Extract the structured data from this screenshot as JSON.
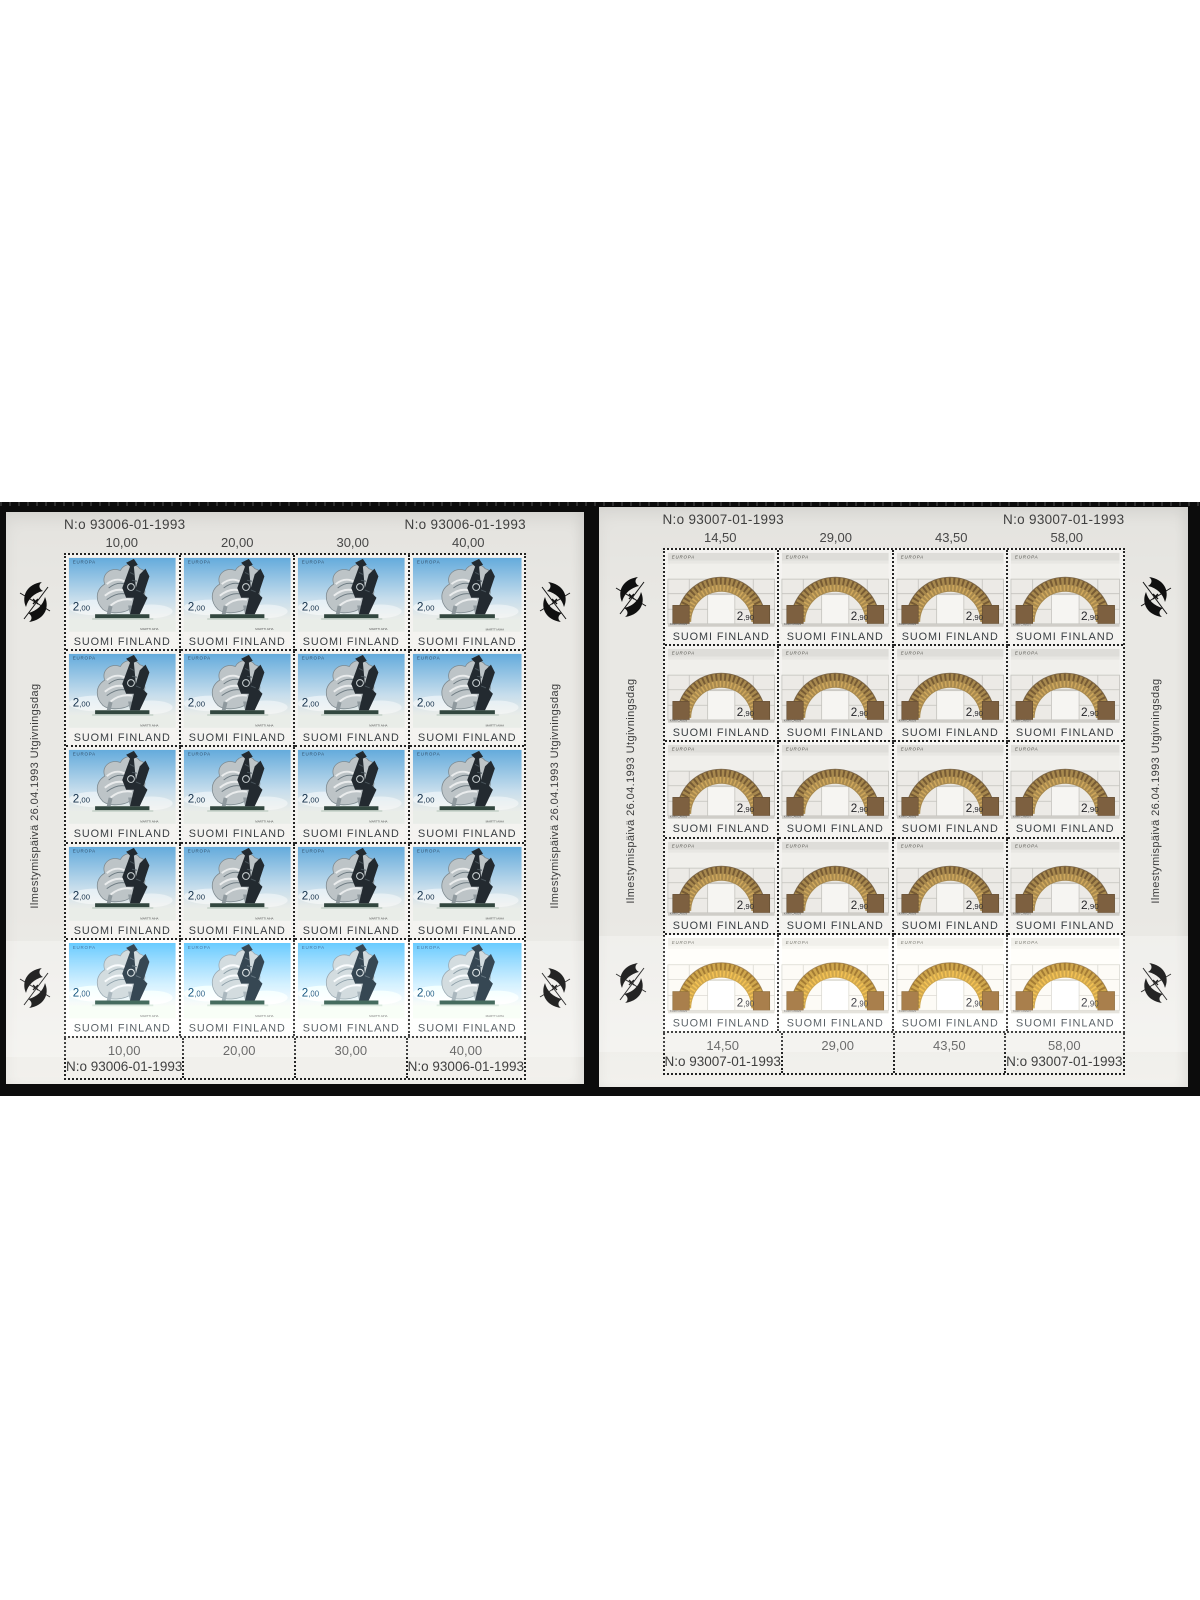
{
  "page": {
    "background": "#ffffff",
    "backdrop_color": "#0c0c0c"
  },
  "palette": {
    "paper": "#e9e8e4",
    "paper2": "#f2f1ed",
    "band": "#0c0c0c",
    "perf": "#232323",
    "ink": "#3e3e3e",
    "sky_top": "#64abdc",
    "sky_mid": "#c6ddec",
    "gray": "#bdc4c7",
    "dark": "#232a30",
    "plinth": "#32473f",
    "rbg": "#f0efeb",
    "arch": "#a8894e",
    "arch_dark": "#6e5430",
    "arch_light": "#d2ab5e",
    "pillar": "#7d6040",
    "panel_line": "#c3c2bd"
  },
  "sheets": [
    {
      "title": "Finland Europa 1993 sheet, 2,00 mk",
      "stamp_template": "stamp-left",
      "rows": 5,
      "cols": 4,
      "plate_number": "N:o 93006-01-1993",
      "header_values": [
        "10,00",
        "20,00",
        "30,00",
        "40,00"
      ],
      "footer_values": [
        "10,00",
        "20,00",
        "30,00",
        "40,00"
      ],
      "margin_text": "Ilmestymispäivä 26.04.1993 Utgivningsdag",
      "stamp": {
        "series": "EUROPA",
        "value_whole": "2",
        "value_cents": ",00",
        "country": "SUOMI FINLAND",
        "artist_signature": "MARTTI AIHA"
      }
    },
    {
      "title": "Finland Europa 1993 sheet, 2,90 mk",
      "stamp_template": "stamp-right",
      "rows": 5,
      "cols": 4,
      "plate_number": "N:o 93007-01-1993",
      "header_values": [
        "14,50",
        "29,00",
        "43,50",
        "58,00"
      ],
      "footer_values": [
        "14,50",
        "29,00",
        "43,50",
        "58,00"
      ],
      "margin_text": "Ilmestymispäivä 26.04.1993 Utgivningsdag",
      "stamp": {
        "series": "EUROPA",
        "value_whole": "2",
        "value_cents": ",90",
        "country": "SUOMI FINLAND",
        "artist_signature": "KARI CAVEN"
      }
    }
  ]
}
